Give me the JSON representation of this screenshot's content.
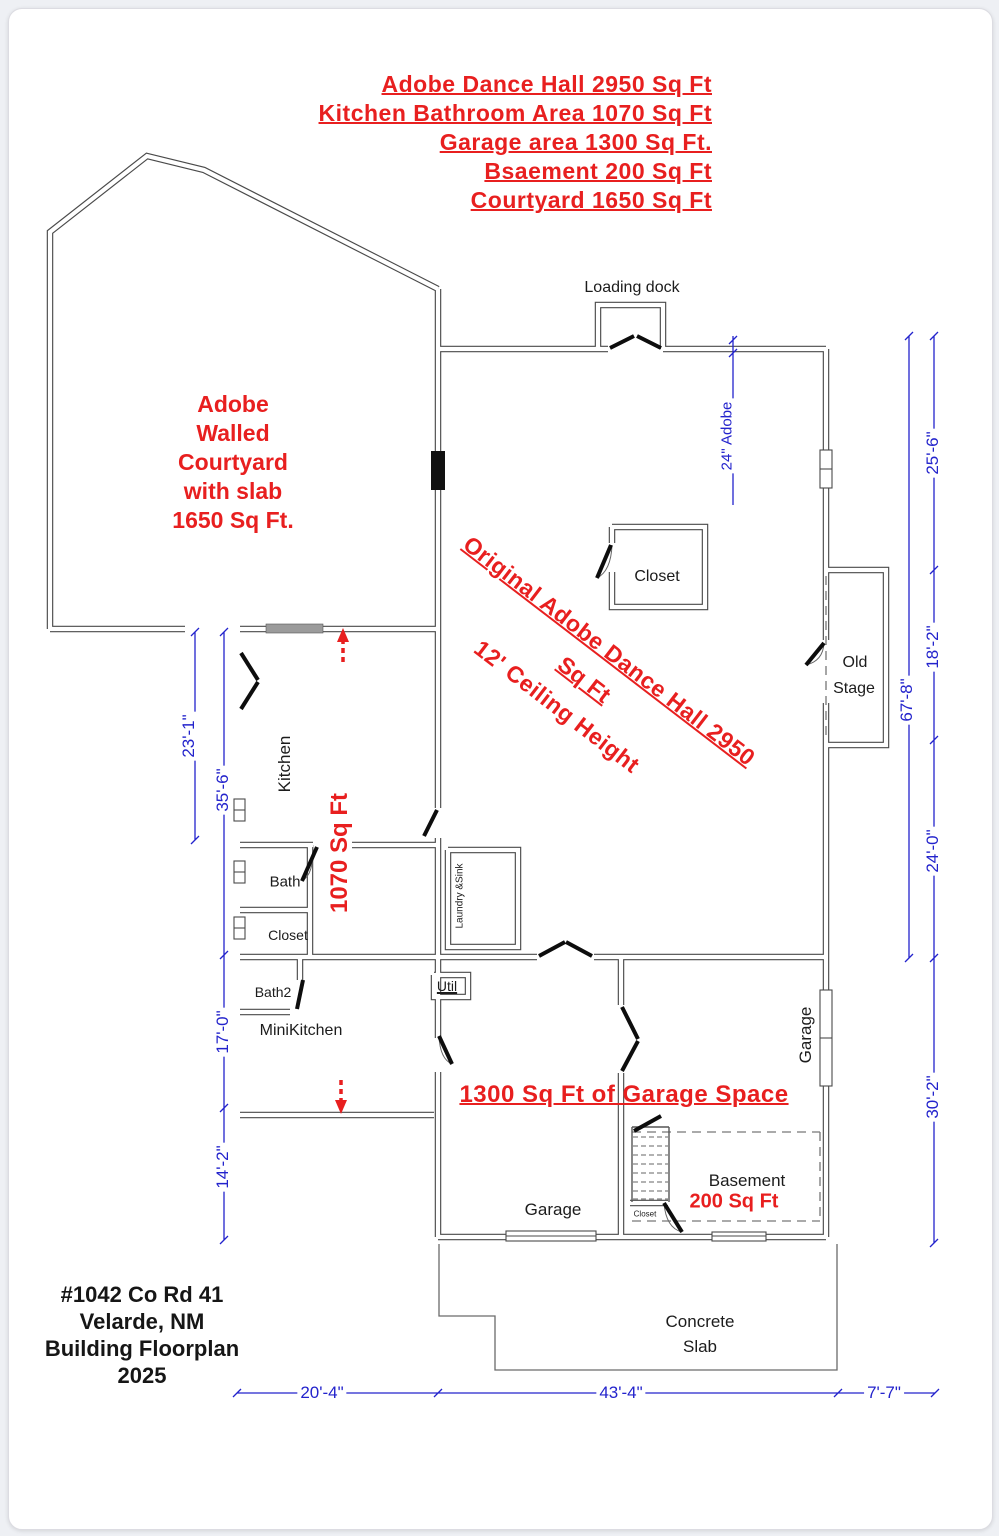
{
  "summary": {
    "lines": [
      "Adobe Dance Hall 2950 Sq Ft",
      "Kitchen Bathroom Area 1070 Sq Ft",
      "Garage area 1300 Sq Ft.",
      "Bsaement 200 Sq Ft",
      "Courtyard 1650 Sq Ft"
    ]
  },
  "courtyard": {
    "lines": [
      "Adobe",
      "Walled",
      "Courtyard",
      "with slab",
      "1650 Sq Ft."
    ]
  },
  "hall": {
    "diag1": "Original Adobe Dance Hall  2950",
    "diag2": "Sq Ft",
    "diag3": "12' Ceiling Height"
  },
  "rooms": {
    "loading_dock": "Loading dock",
    "closet": "Closet",
    "old_stage_1": "Old",
    "old_stage_2": "Stage",
    "kitchen": "Kitchen",
    "bath": "Bath",
    "kitchen_closet": "Closet",
    "bath2": "Bath2",
    "minikitchen": "MiniKitchen",
    "util": "Util",
    "laundry": "Laundry &Sink",
    "garage_left": "Garage",
    "garage_right": "Garage",
    "basement": "Basement",
    "basement_sqft": "200 Sq Ft",
    "basement_closet": "Closet",
    "concrete_1": "Concrete",
    "concrete_2": "Slab"
  },
  "annotations": {
    "kitchen_sqft": "1070 Sq Ft",
    "garage_sqft": "1300 Sq Ft of Garage Space"
  },
  "dims": {
    "left": [
      "23'-1\"",
      "35'-6\"",
      "17'-0\"",
      "14'-2\""
    ],
    "right_total": "67'-8\"",
    "right": [
      "25'-6\"",
      "18'-2\"",
      "24'-0\"",
      "30'-2\""
    ],
    "bottom": [
      "20'-4\"",
      "43'-4\"",
      "7'-7\""
    ],
    "wall": "24\" Adobe"
  },
  "titleblock": {
    "lines": [
      "#1042 Co Rd 41",
      "Velarde, NM",
      "Building Floorplan",
      "2025"
    ]
  },
  "colors": {
    "annotation_red": "#e81f1f",
    "dimension_blue": "#2323cc",
    "wall_gray": "#4a4a4a",
    "paper": "#ffffff",
    "background": "#eef0f4"
  }
}
